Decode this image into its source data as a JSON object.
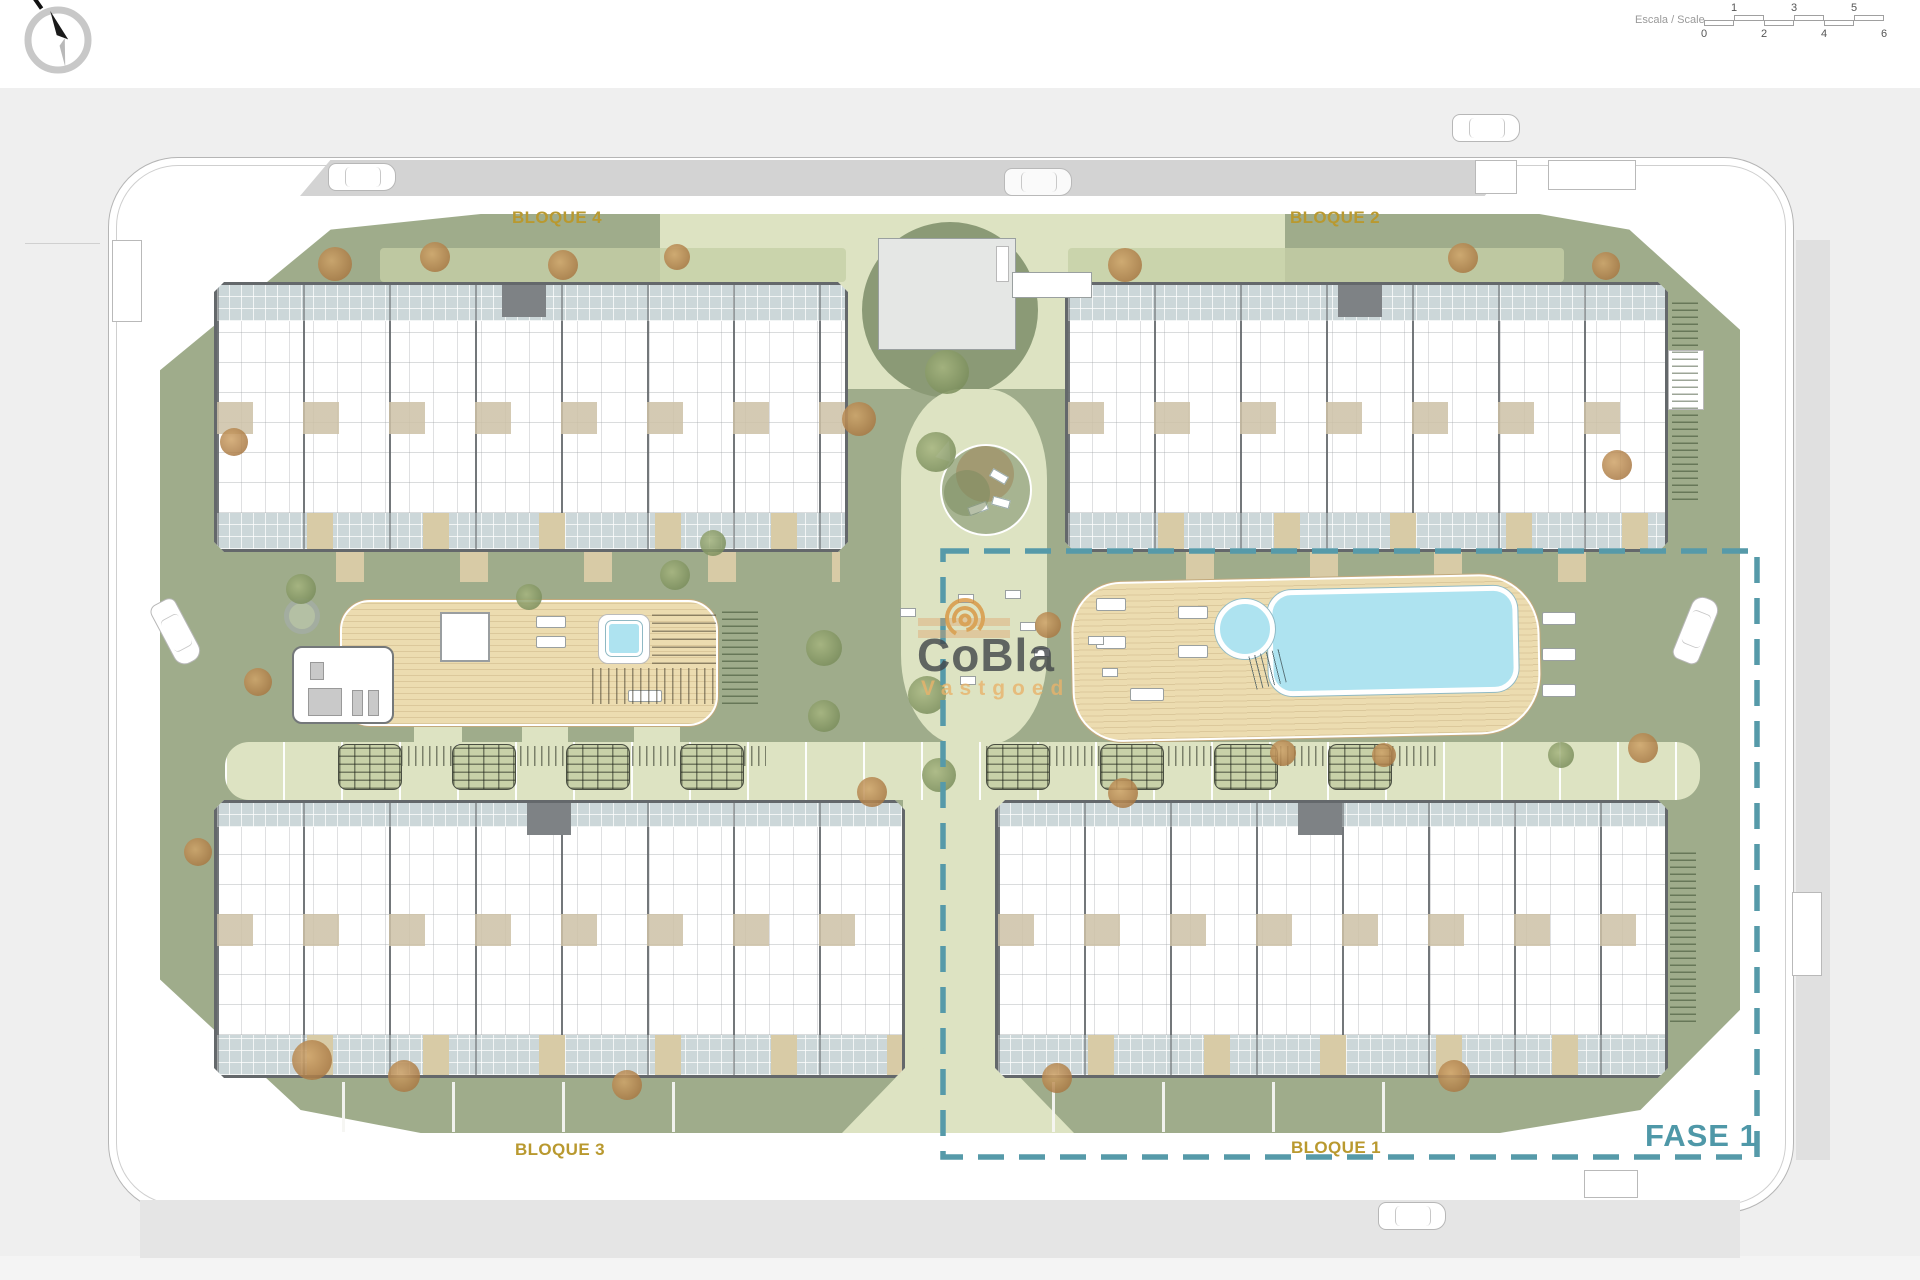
{
  "title": "Residential development site plan",
  "compass": {
    "icon": "compass-north-icon"
  },
  "scale_bar": {
    "label": "Escala / Scale",
    "top_ticks": [
      "1",
      "3",
      "5"
    ],
    "bottom_ticks": [
      "0",
      "2",
      "4",
      "6"
    ]
  },
  "blocks": [
    {
      "id": "bloque-4",
      "label": "BLOQUE 4"
    },
    {
      "id": "bloque-2",
      "label": "BLOQUE 2"
    },
    {
      "id": "bloque-3",
      "label": "BLOQUE 3"
    },
    {
      "id": "bloque-1",
      "label": "BLOQUE 1"
    }
  ],
  "phase": {
    "label": "FASE 1"
  },
  "watermark": {
    "brand": "CoBla",
    "subtitle": "Vastgoed",
    "icon": "spiral-logo-icon"
  },
  "colors": {
    "block_label_gold": "#b9992f",
    "phase_teal": "#569aa9",
    "pool_blue": "#aee3f0",
    "deck_tan": "#ecdcb0",
    "lawn_green": "#9fac8b",
    "path_green": "#dde3c2",
    "terrace_tile": "#ccd7d9",
    "wall_gray": "#64686b",
    "watermark_orange": "#d9953f"
  }
}
